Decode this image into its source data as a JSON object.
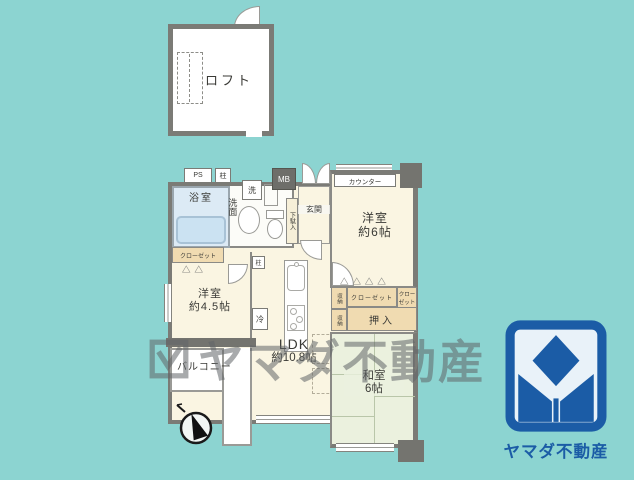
{
  "colors": {
    "background": "#8CD4D1",
    "room_cream": "#FAF5E2",
    "bath_blue": "#DCEAF5",
    "storage_tan": "#F0DBB1",
    "tatami_green": "#EBF1DE",
    "wall_gray": "#7B7B76",
    "logo_blue": "#1B5CA6"
  },
  "loft": {
    "label": "ロフト"
  },
  "floor": {
    "ps": "PS",
    "pillar1": "柱",
    "pillar2": "柱",
    "mb": "MB",
    "bath": "浴室",
    "washer": "洗",
    "washroom": "洗面",
    "shoe_cabinet": "下駄入",
    "entrance": "玄関",
    "counter": "カウンター",
    "western6_l1": "洋室",
    "western6_l2": "約6帖",
    "closet45": "クローゼット",
    "western45_l1": "洋室",
    "western45_l2": "約4.5帖",
    "fridge": "冷",
    "ldk_l1": "LDK",
    "ldk_l2": "約10.8帖",
    "storage_top": "収納",
    "storage_bottom": "収納",
    "closet_wide": "クローゼット",
    "closet_small_l1": "クロー",
    "closet_small_l2": "ゼット",
    "oshiire": "押入",
    "washitsu_l1": "和室",
    "washitsu_l2": "6帖",
    "balcony": "バルコニー",
    "folding_door_icon": "△△△△",
    "folding_door_icon_small": "△△"
  },
  "watermark": {
    "text": "ヤマダ不動産"
  },
  "logo": {
    "text": "ヤマダ不動産"
  }
}
